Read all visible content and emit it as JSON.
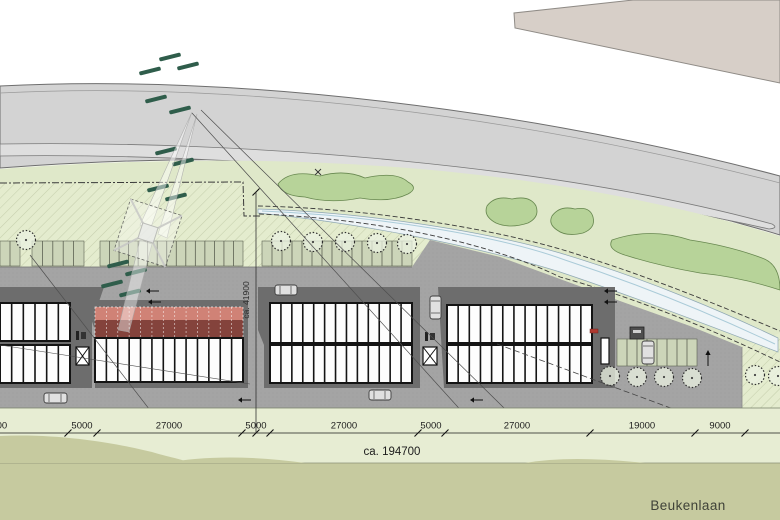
{
  "plan_title": "site plan",
  "street_label": {
    "text": "Beukenlaan",
    "x": 688,
    "y": 510
  },
  "total_dimension": {
    "text": "ca. 194700",
    "x": 392,
    "y": 455
  },
  "vertical_dimension": {
    "text": "ca. 41900",
    "x": 256,
    "y1": 192,
    "y2": 433,
    "label_x": 249,
    "label_y": 300
  },
  "dimension_line": {
    "y": 433,
    "tick_xs": [
      68,
      97,
      242,
      270,
      418,
      445,
      590,
      695,
      745
    ],
    "labels": [
      {
        "text": "27000",
        "x": -6
      },
      {
        "text": "5000",
        "x": 82
      },
      {
        "text": "27000",
        "x": 169
      },
      {
        "text": "5000",
        "x": 256
      },
      {
        "text": "27000",
        "x": 344
      },
      {
        "text": "5000",
        "x": 431
      },
      {
        "text": "27000",
        "x": 517
      },
      {
        "text": "19000",
        "x": 642
      },
      {
        "text": "9000",
        "x": 720
      }
    ]
  },
  "colors": {
    "road": "#d3d3d3",
    "road_lane": "#dedede",
    "road_edge": "#6e6e6e",
    "beige_area": "#d7cfc8",
    "verge_green": "#dfe8c9",
    "shrub_green": "#b7d399",
    "shrub_edge": "#67874f",
    "ditch_fill": "#eef4f7",
    "ditch_edge": "#8fa8b4",
    "yard_gray": "#a4a4a4",
    "building_dark": "#6d6d6d",
    "stall_white": "#fdfdfd",
    "stall_divider": "#141414",
    "red_light": "#d08276",
    "red_dark": "#84433c",
    "parking_green": "#ccd5b9",
    "parking_divider": "#5c6152",
    "pale_band": "#e7edd3",
    "olive_green": "#c6ca9f",
    "hedge_dash_green": "#2f5d4b",
    "boundary_line": "#3a3a3a",
    "car_body": "#e0e0e0"
  },
  "parking_top": {
    "y0": 241,
    "y1": 266,
    "groups": [
      {
        "x0": 0,
        "x1": 20,
        "n": 2
      },
      {
        "x0": 32,
        "x1": 84,
        "n": 5
      },
      {
        "x0": 100,
        "x1": 243,
        "n": 15
      },
      {
        "x0": 262,
        "x1": 412,
        "n": 15
      }
    ]
  },
  "parking_right": {
    "x0": 617,
    "x1": 697,
    "y0": 339,
    "y1": 366,
    "n": 8
  },
  "trees": {
    "r": 9.5,
    "top": [
      [
        26,
        240
      ],
      [
        281,
        241
      ],
      [
        313,
        242
      ],
      [
        345,
        242
      ],
      [
        377,
        243
      ],
      [
        407,
        244
      ]
    ],
    "bottom": [
      [
        610,
        376
      ],
      [
        637,
        377
      ],
      [
        664,
        377
      ],
      [
        692,
        378
      ],
      [
        755,
        375
      ],
      [
        778,
        376
      ]
    ]
  },
  "buildings": [
    {
      "id": "A",
      "dark": [
        [
          0,
          287
        ],
        [
          104,
          287
        ],
        [
          92,
          322
        ],
        [
          92,
          388
        ],
        [
          0,
          388
        ]
      ],
      "rows": [
        {
          "x0": 0,
          "x1": 70,
          "y0": 303,
          "y1": 341,
          "n": 6
        },
        {
          "x0": 0,
          "x1": 70,
          "y0": 345,
          "y1": 383,
          "n": 6
        }
      ]
    },
    {
      "id": "B",
      "dark": [
        [
          90,
          300
        ],
        [
          248,
          300
        ],
        [
          248,
          388
        ],
        [
          95,
          388
        ],
        [
          95,
          330
        ],
        [
          90,
          316
        ]
      ],
      "red": {
        "x0": 95,
        "x1": 243,
        "y_top": 307,
        "y_mid": 320,
        "y_bot": 338,
        "n": 13
      },
      "rows": [
        {
          "x0": 95,
          "x1": 243,
          "y0": 338,
          "y1": 382,
          "n": 13
        }
      ]
    },
    {
      "id": "C",
      "dark": [
        [
          258,
          287
        ],
        [
          420,
          287
        ],
        [
          420,
          388
        ],
        [
          264,
          388
        ],
        [
          264,
          345
        ],
        [
          258,
          330
        ]
      ],
      "rows": [
        {
          "x0": 270,
          "x1": 412,
          "y0": 303,
          "y1": 343,
          "n": 13
        },
        {
          "x0": 270,
          "x1": 412,
          "y0": 345,
          "y1": 383,
          "n": 13
        }
      ]
    },
    {
      "id": "D",
      "dark": [
        [
          438,
          287
        ],
        [
          615,
          287
        ],
        [
          615,
          388
        ],
        [
          444,
          388
        ]
      ],
      "rows": [
        {
          "x0": 447,
          "x1": 592,
          "y0": 305,
          "y1": 343,
          "n": 13
        },
        {
          "x0": 447,
          "x1": 592,
          "y0": 345,
          "y1": 383,
          "n": 13
        }
      ],
      "slits": [
        [
          601,
          338,
          8,
          26
        ]
      ]
    }
  ],
  "cars": [
    {
      "x": 44,
      "y": 393,
      "w": 23,
      "h": 10
    },
    {
      "x": 369,
      "y": 390,
      "w": 22,
      "h": 10
    },
    {
      "x": 275,
      "y": 285,
      "w": 22,
      "h": 10
    },
    {
      "x": 430,
      "y": 296,
      "w": 11,
      "h": 23
    },
    {
      "x": 642,
      "y": 341,
      "w": 12,
      "h": 23
    }
  ],
  "hedge_dashes": [
    [
      170,
      57
    ],
    [
      150,
      71
    ],
    [
      188,
      66
    ],
    [
      156,
      99
    ],
    [
      180,
      110
    ],
    [
      166,
      151
    ],
    [
      183,
      162
    ],
    [
      158,
      188
    ],
    [
      176,
      197
    ],
    [
      118,
      264
    ],
    [
      136,
      272
    ],
    [
      112,
      284
    ],
    [
      130,
      293
    ]
  ],
  "arrows": [
    {
      "x": 146,
      "y": 291,
      "dir": "left"
    },
    {
      "x": 148,
      "y": 302,
      "dir": "left"
    },
    {
      "x": 604,
      "y": 291,
      "dir": "left"
    },
    {
      "x": 604,
      "y": 302,
      "dir": "left"
    },
    {
      "x": 238,
      "y": 400,
      "dir": "left"
    },
    {
      "x": 470,
      "y": 400,
      "dir": "left"
    },
    {
      "x": 708,
      "y": 366,
      "dir": "up"
    }
  ],
  "icons": {
    "stair_boxes": [
      [
        76,
        347,
        13,
        18
      ],
      [
        423,
        347,
        14,
        18
      ]
    ],
    "bike_racks": [
      [
        76,
        331
      ],
      [
        425,
        332
      ]
    ],
    "red_marker": [
      590,
      329,
      8,
      4
    ],
    "utility_box": [
      630,
      327,
      14,
      12
    ]
  }
}
